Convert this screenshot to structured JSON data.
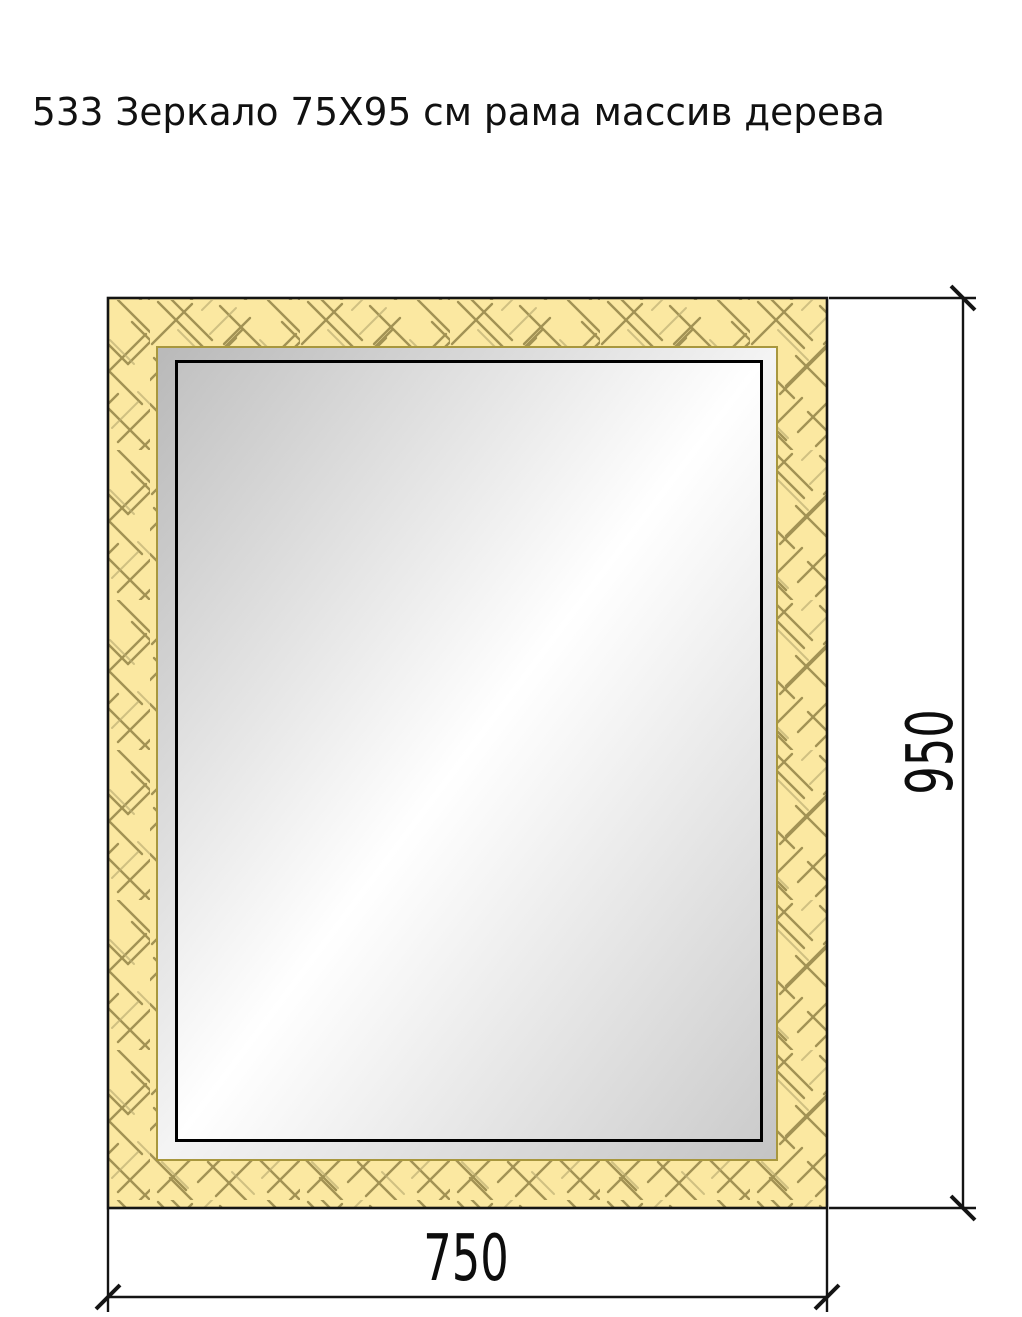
{
  "title": "533 Зеркало 75X95 см рама массив дерева",
  "dimensions": {
    "width": {
      "label": "750"
    },
    "height": {
      "label": "950"
    }
  },
  "colors": {
    "background": "#ffffff",
    "line_dark": "#141414",
    "glass_border": "#000000",
    "wood_fill": "#fbe8a1",
    "wood_hatch": "#a29254",
    "wood_hatch_light": "#b9ab70",
    "bevel_border_gold": "#a8973e",
    "glass_corner_dark": "#c2c2c2",
    "glass_highlight": "#ffffff",
    "glass_corner_dark2": "#cccccc",
    "bevel_corner_dark": "#b9b9b9",
    "bevel_highlight": "#f4f4f4",
    "bevel_corner_dark2": "#c4c4c4"
  }
}
